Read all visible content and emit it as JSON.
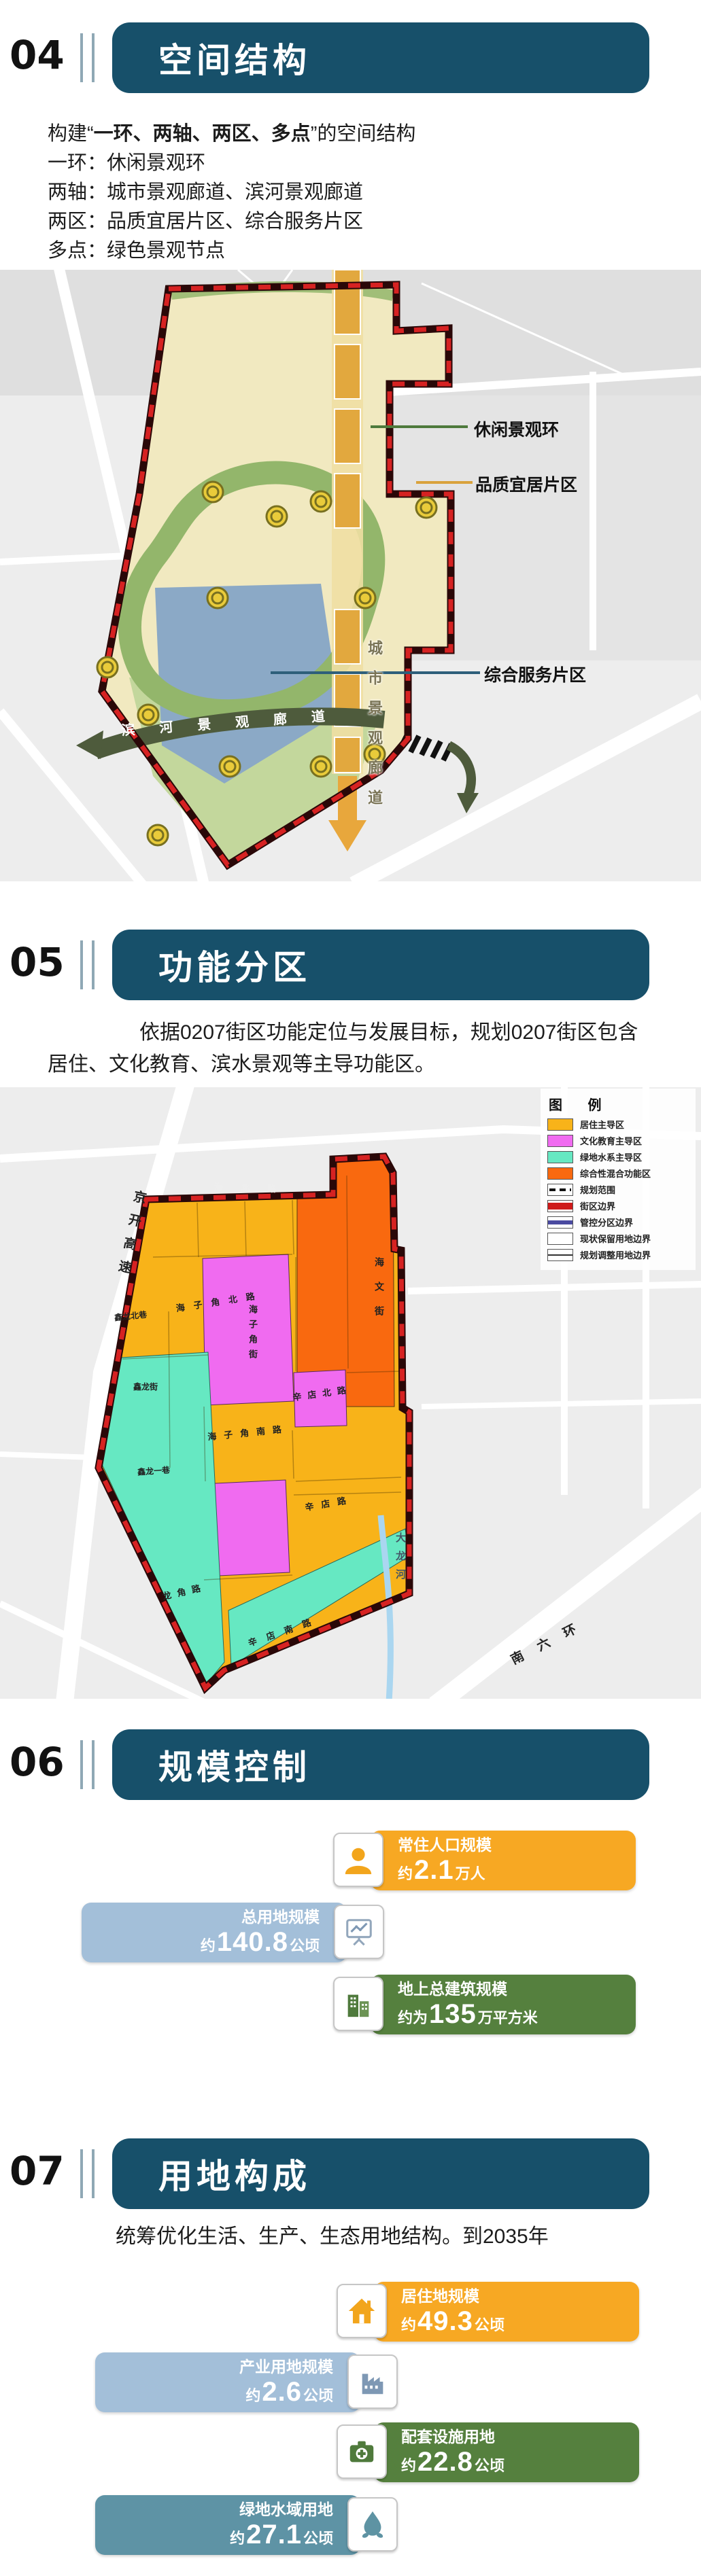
{
  "colors": {
    "titlebar_teal": "#17506A",
    "amber_card": "#F7A823",
    "blue_card": "#A3BFD9",
    "green_card": "#55803E",
    "teal_card": "#5E93A5",
    "boundary_red": "#D62222",
    "legend_amber": "#F8B319",
    "legend_magenta": "#F06BF0",
    "legend_aqua": "#66E8C2",
    "legend_orange": "#F9690F"
  },
  "sections": {
    "s04": {
      "num": "04",
      "title": "空间结构",
      "para": {
        "prefix": "构建“",
        "bold": "一环、两轴、两区、多点",
        "suffix": "”的空间结构"
      },
      "lines": [
        "一环：休闲景观环",
        "两轴：城市景观廊道、滨河景观廊道",
        "两区：品质宜居片区、综合服务片区",
        "多点：绿色景观节点"
      ],
      "map": {
        "label_ring": "休闲景观环",
        "label_residential": "品质宜居片区",
        "label_service": "综合服务片区",
        "corridor_city": "城市景观廊道",
        "corridor_river": "滨河景观廊道"
      }
    },
    "s05": {
      "num": "05",
      "title": "功能分区",
      "para_line1": "依据0207街区功能定位与发展目标，规划0207街区包含",
      "para_line2": "居住、文化教育、滨水景观等主导功能区。",
      "legend": {
        "title": "图 例",
        "items": [
          {
            "label": "居住主导区"
          },
          {
            "label": "文化教育主导区"
          },
          {
            "label": "绿地水系主导区"
          },
          {
            "label": "综合性混合功能区"
          },
          {
            "label": "规划范围"
          },
          {
            "label": "街区边界"
          },
          {
            "label": "管控分区边界"
          },
          {
            "label": "现状保留用地边界"
          },
          {
            "label": "规划调整用地边界"
          }
        ]
      },
      "streets": {
        "haibei": "海北路",
        "jingkai": "京开高速",
        "haizijiao_north": "海子角北路",
        "haizijiao_street": "海子角街",
        "haizijiao_south": "海子角南路",
        "xindian_north": "辛店北路",
        "xindian": "辛店路",
        "xindian_south": "辛店南路",
        "haiwen": "海文街",
        "xinlong_north": "鑫龙北巷",
        "xinlong": "鑫龙街",
        "xinlong_first": "鑫龙一巷",
        "longjiao": "龙角路",
        "dalonghe": "大龙河",
        "nanliuhuan": "南六环"
      }
    },
    "s06": {
      "num": "06",
      "title": "规模控制",
      "cards": [
        {
          "label": "常住人口规模",
          "prefix": "约",
          "value": "2.1",
          "unit": "万人"
        },
        {
          "label": "总用地规模",
          "prefix": "约",
          "value": "140.8",
          "unit": "公顷"
        },
        {
          "label": "地上总建筑规模",
          "prefix": "约为",
          "value": "135",
          "unit": "万平方米"
        }
      ]
    },
    "s07": {
      "num": "07",
      "title": "用地构成",
      "para": "统筹优化生活、生产、生态用地结构。到2035年",
      "cards": [
        {
          "label": "居住地规模",
          "prefix": "约",
          "value": "49.3",
          "unit": "公顷"
        },
        {
          "label": "产业用地规模",
          "prefix": "约",
          "value": "2.6",
          "unit": "公顷"
        },
        {
          "label": "配套设施用地",
          "prefix": "约",
          "value": "22.8",
          "unit": "公顷"
        },
        {
          "label": "绿地水域用地",
          "prefix": "约",
          "value": "27.1",
          "unit": "公顷"
        }
      ]
    }
  }
}
